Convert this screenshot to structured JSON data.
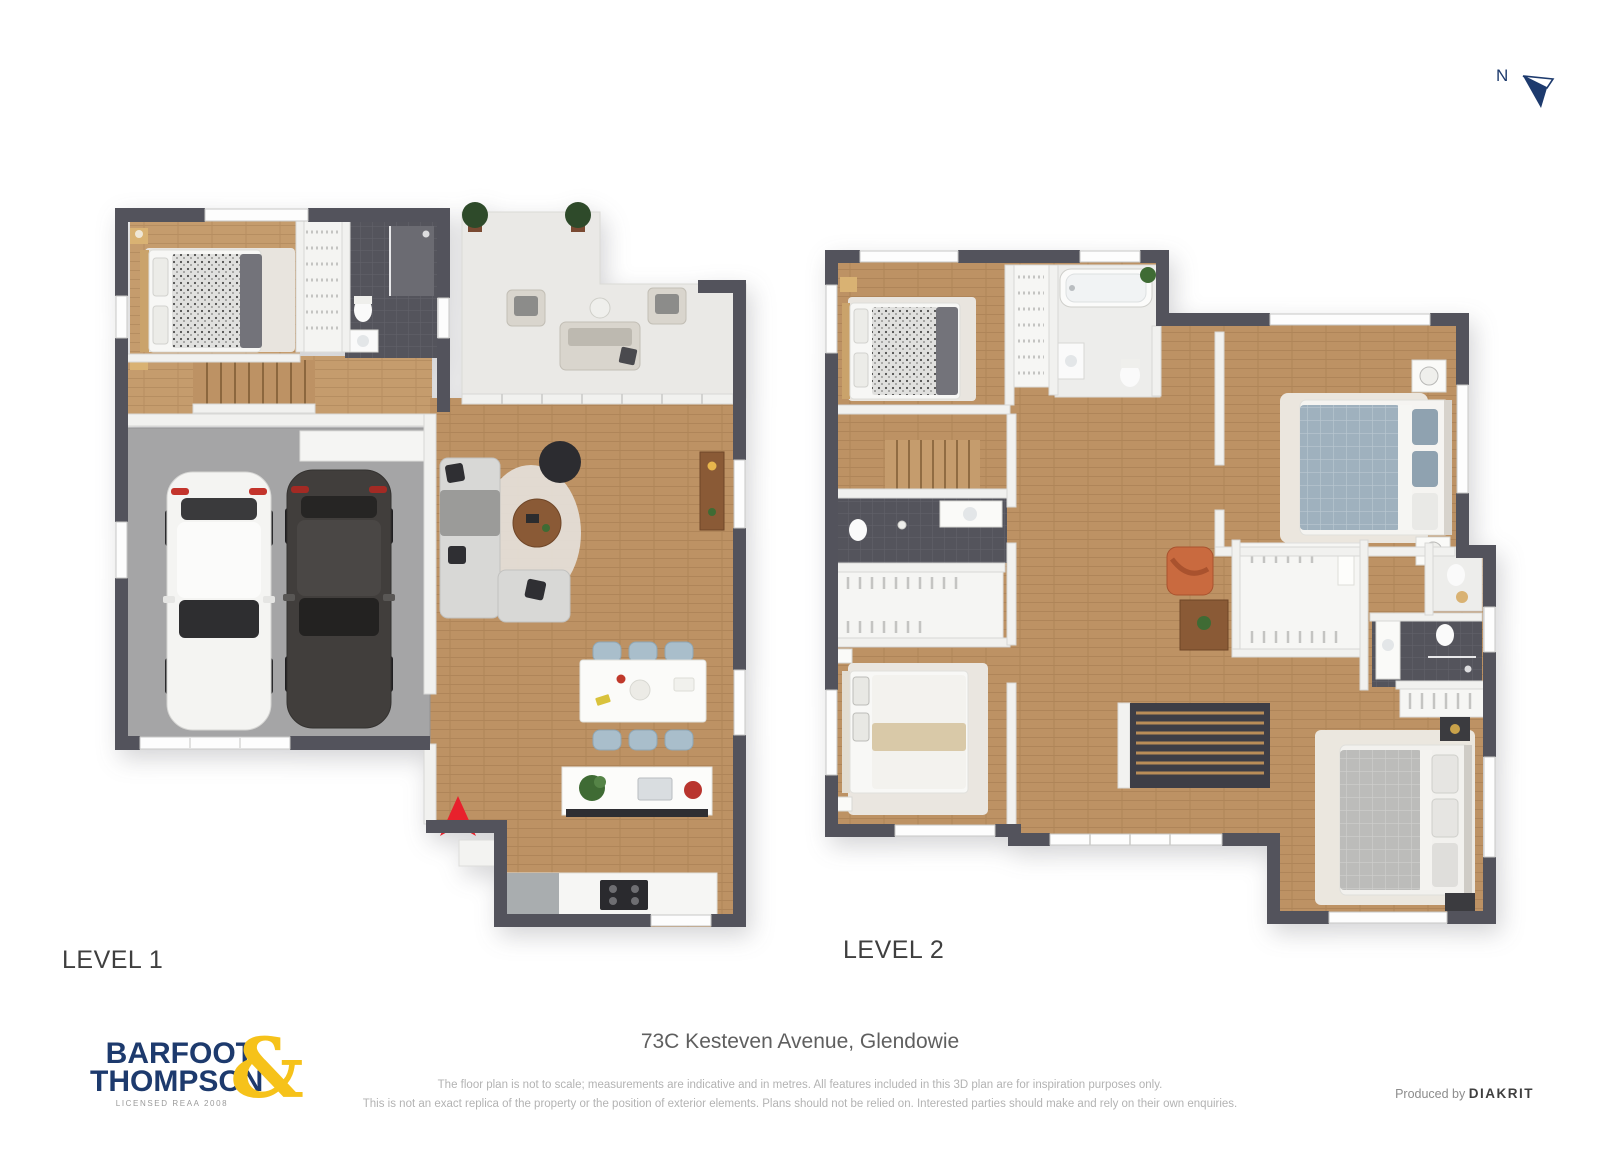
{
  "compass": {
    "label": "N"
  },
  "levels": [
    {
      "label": "LEVEL 1"
    },
    {
      "label": "LEVEL 2"
    }
  ],
  "footer": {
    "address": "73C Kesteven Avenue, Glendowie",
    "disclaimer1": "The floor plan is not to scale; measurements are indicative and in metres. All features included in this 3D plan are for inspiration purposes only.",
    "disclaimer2": "This is not an exact replica of the property or the position of exterior elements. Plans should not be relied on. Interested parties should make and rely on their own enquiries.",
    "produced_by": "Produced by",
    "producer": "DIAKRIT",
    "logo": {
      "line1": "BARFOOT",
      "line2": "THOMPSON",
      "ampersand": "&",
      "licence": "LICENSED REAA 2008"
    }
  },
  "colors": {
    "wall": "#53535c",
    "wood": "#c59c6d",
    "wood2": "#bd9264",
    "garage": "#a5a5a6",
    "patio": "#eae9e6",
    "tile": "#54545c",
    "interior": "#f1f1ef",
    "sofa": "#d8d8d6",
    "bedblue": "#9fb1be",
    "chairblue": "#a9becb",
    "accent": "#e8212c",
    "navy": "#1d3a6d",
    "gold": "#f6c21a",
    "textdark": "#3f3f3f",
    "textmid": "#5f5f5f",
    "textgray": "#b3b3b3"
  }
}
